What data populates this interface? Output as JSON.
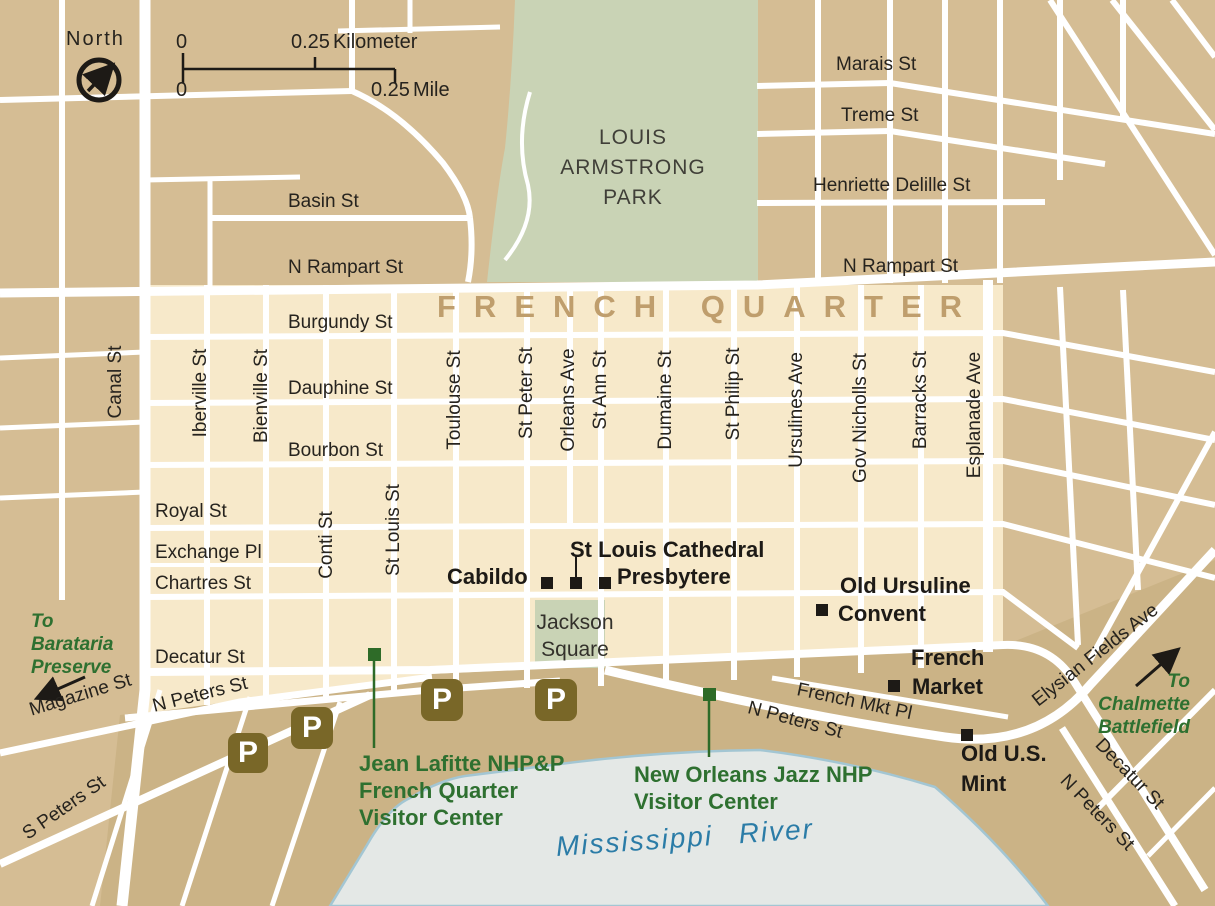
{
  "compass": {
    "label": "North"
  },
  "scale": {
    "km_zero": "0",
    "km_value": "0.25",
    "km_unit": "Kilometer",
    "mi_zero": "0",
    "mi_value": "0.25",
    "mi_unit": "Mile"
  },
  "region_label": "FRENCH QUARTER",
  "areas": {
    "park_l1": "LOUIS",
    "park_l2": "ARMSTRONG",
    "park_l3": "PARK",
    "jackson_l1": "Jackson",
    "jackson_l2": "Square",
    "river": "Mississippi River"
  },
  "streets": {
    "basin": "Basin St",
    "n_rampart_left": "N Rampart St",
    "n_rampart_right": "N Rampart St",
    "marais": "Marais St",
    "treme": "Treme St",
    "henriette_delille": "Henriette Delille St",
    "burgundy": "Burgundy St",
    "dauphine": "Dauphine St",
    "bourbon": "Bourbon St",
    "royal": "Royal St",
    "exchange": "Exchange Pl",
    "chartres": "Chartres St",
    "decatur": "Decatur St",
    "canal": "Canal St",
    "iberville": "Iberville St",
    "bienville": "Bienville St",
    "conti": "Conti St",
    "st_louis": "St Louis St",
    "toulouse": "Toulouse St",
    "st_peter": "St Peter St",
    "orleans": "Orleans Ave",
    "st_ann": "St Ann St",
    "dumaine": "Dumaine St",
    "st_philip": "St Philip St",
    "ursulines": "Ursulines Ave",
    "gov_nicholls": "Gov Nicholls St",
    "barracks": "Barracks St",
    "esplanade": "Esplanade Ave",
    "magazine": "Magazine St",
    "s_peters": "S Peters St",
    "n_peters_left": "N Peters St",
    "n_peters_right": "N Peters St",
    "n_peters_se": "N Peters St",
    "french_mkt_pl": "French Mkt Pl",
    "elysian_fields": "Elysian Fields Ave",
    "decatur_se": "Decatur St"
  },
  "landmarks": {
    "cathedral": "St Louis Cathedral",
    "cabildo": "Cabildo",
    "presbytere": "Presbytere",
    "ursuline_l1": "Old Ursuline",
    "ursuline_l2": "Convent",
    "market_l1": "French",
    "market_l2": "Market",
    "mint_l1": "Old U.S.",
    "mint_l2": "Mint"
  },
  "guides": {
    "barataria_l1": "To",
    "barataria_l2": "Barataria",
    "barataria_l3": "Preserve",
    "chalmette_l1": "To",
    "chalmette_l2": "Chalmette",
    "chalmette_l3": "Battlefield"
  },
  "visitor_centers": {
    "jl_l1": "Jean Lafitte NHP&P",
    "jl_l2": "French Quarter",
    "jl_l3": "Visitor Center",
    "jazz_l1": "New Orleans Jazz NHP",
    "jazz_l2": "Visitor Center"
  },
  "parking_label": "P",
  "colors": {
    "block_tan": "#d5bd94",
    "block_cream": "#f7e9ca",
    "bank_tan": "#cbb386",
    "park_green": "#c9d3b5",
    "water": "#e4e8e6",
    "water_edge": "#a3c6d3",
    "street_white": "#ffffff",
    "quarter_label": "#bf9e6d",
    "guide_green": "#2e7030",
    "parking_brown": "#796728",
    "river_text_blue": "#2b7ca7",
    "poi_black": "#1d1a16"
  }
}
